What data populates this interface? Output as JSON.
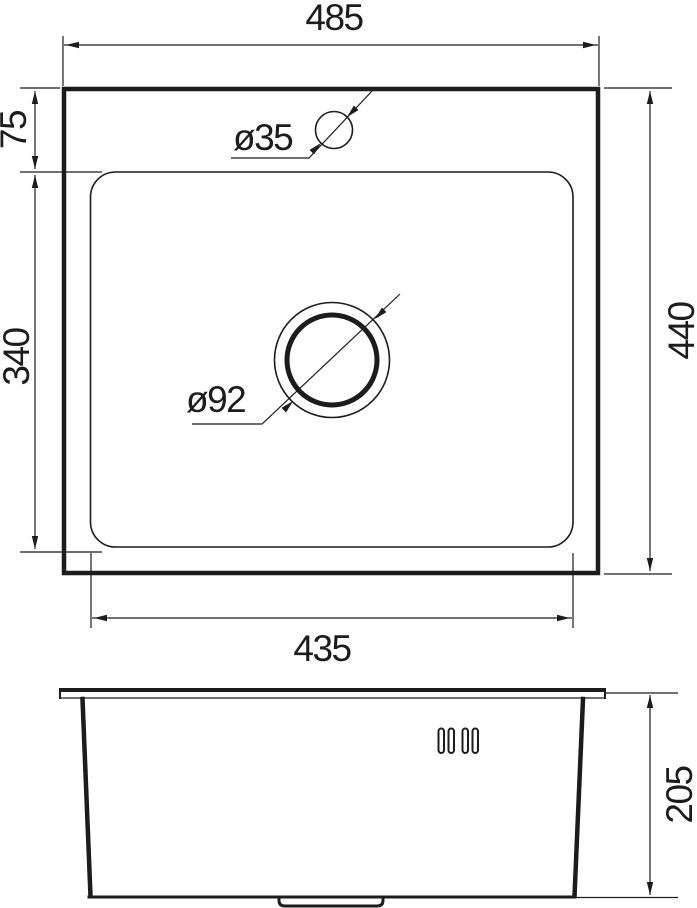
{
  "drawing": {
    "type": "sink-dimension-drawing",
    "colors": {
      "line": "#1c1c1c",
      "background": "#ffffff"
    },
    "top_view": {
      "labels": {
        "overall_width": "485",
        "overall_depth": "440",
        "faucet_offset": "75",
        "bowl_depth": "340",
        "bowl_width": "435",
        "faucet_hole_diameter": "ø35",
        "drain_hole_diameter": "ø92"
      }
    },
    "side_view": {
      "labels": {
        "height": "205"
      }
    }
  }
}
